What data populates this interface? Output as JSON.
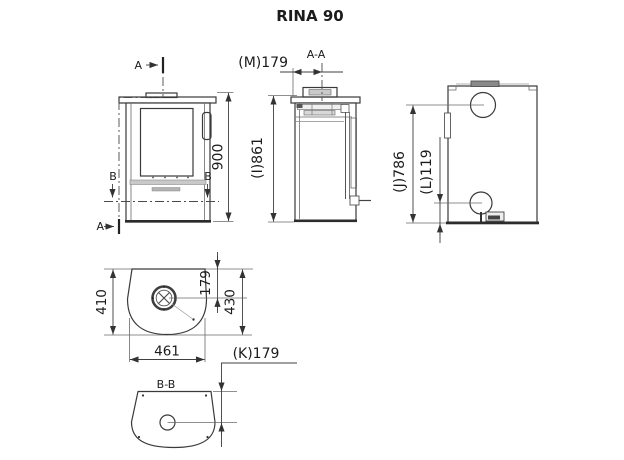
{
  "title": "RINA 90",
  "front_view": {
    "section_marker_top": "A",
    "section_marker_bottom": "A",
    "section_marker_left": "B",
    "section_marker_right": "B",
    "height_dim": "900"
  },
  "section_view": {
    "label": "A-A",
    "flue_offset_dim": "(M)179",
    "body_height_dim": "(I)861"
  },
  "back_view": {
    "top_outlet_height_dim": "(J)786",
    "bottom_inlet_height_dim": "(L)119"
  },
  "top_view": {
    "body_depth_dim": "410",
    "flue_offset_dim": "179",
    "total_depth_dim": "430",
    "width_dim": "461"
  },
  "bottom_view": {
    "label": "B-B",
    "outlet_offset_dim": "(K)179"
  },
  "colors": {
    "line": "#3a3a3a",
    "heavy_line": "#2c2c2c",
    "fill_light": "#ececec",
    "fill_band": "#c9c9c9",
    "background": "#ffffff"
  }
}
